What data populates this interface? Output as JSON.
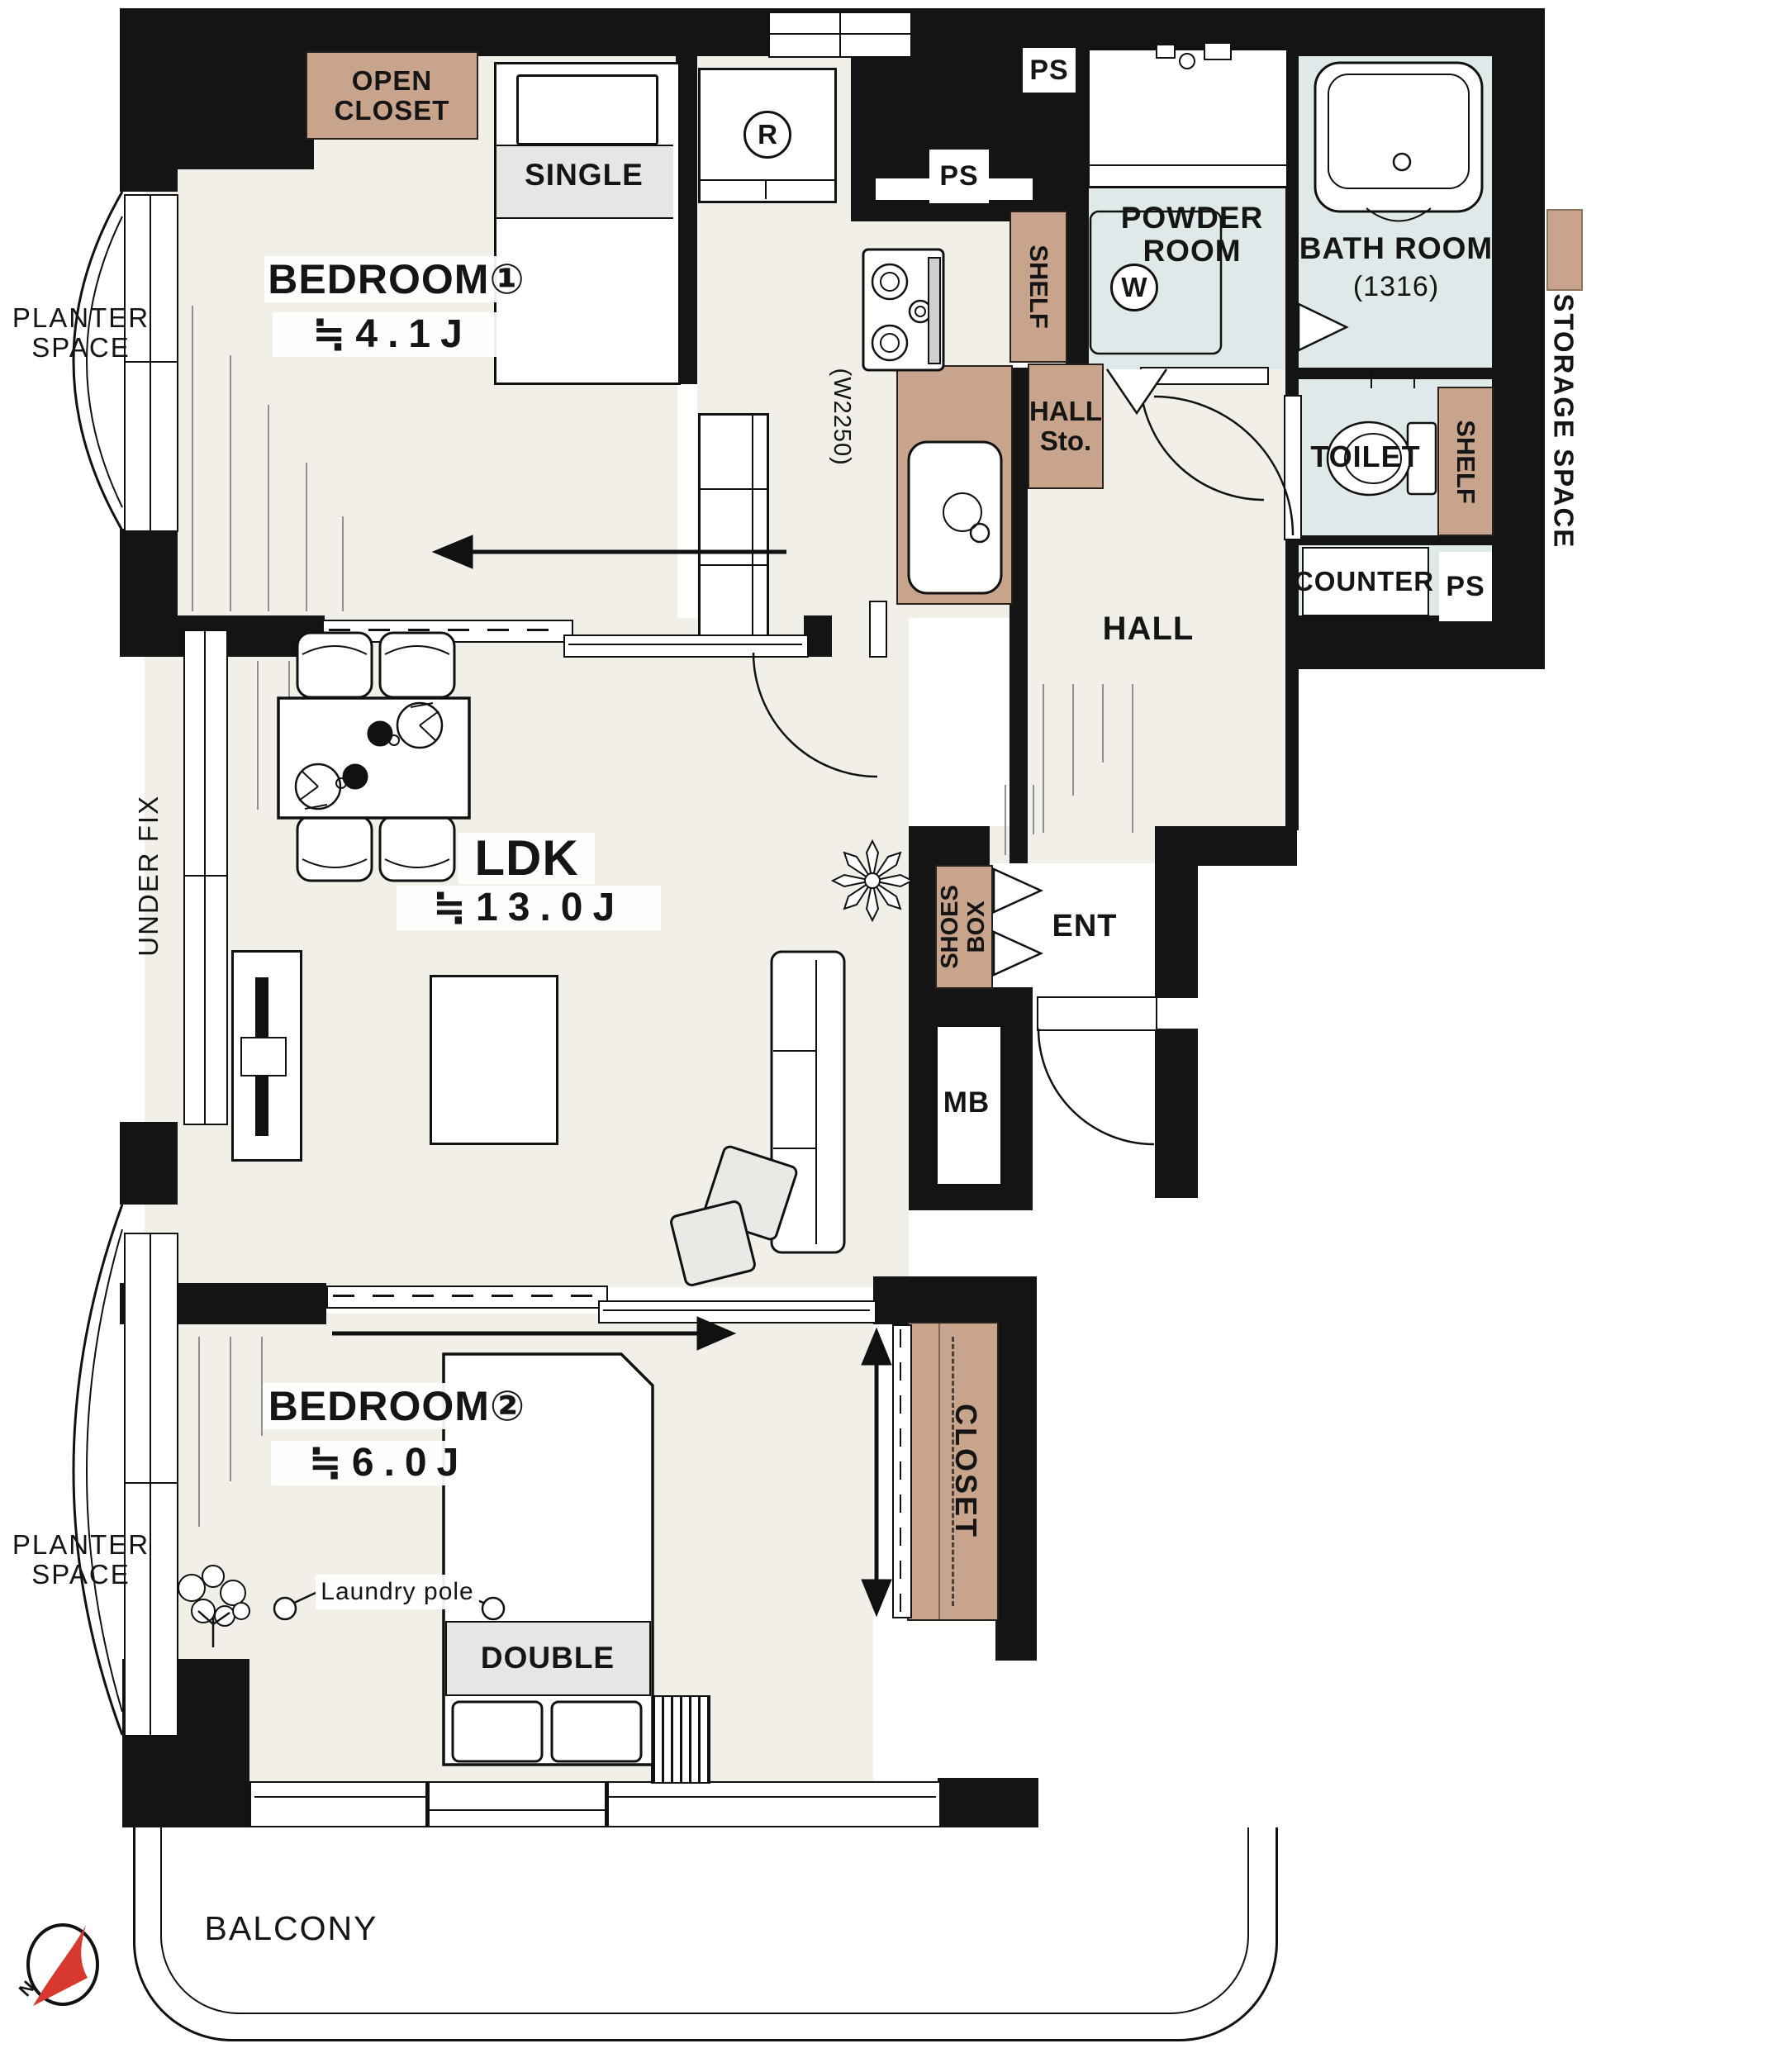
{
  "colors": {
    "wall": "#141414",
    "floor": "#f2efe8",
    "wet": "#dfe9e9",
    "tan": "#c9a48c",
    "grey": "#e6e6e4",
    "accent": "#d8392f",
    "line": "#111111"
  },
  "rooms": {
    "bedroom1": {
      "name": "BEDROOM①",
      "area": "≒4.1J"
    },
    "bedroom2": {
      "name": "BEDROOM②",
      "area": "≒6.0J"
    },
    "ldk": {
      "name": "LDK",
      "area": "≒13.0J"
    },
    "powder": {
      "l1": "POWDER",
      "l2": "ROOM"
    },
    "bath": {
      "name": "BATH ROOM",
      "size": "(1316)"
    },
    "toilet": {
      "name": "TOILET"
    },
    "hall": {
      "name": "HALL"
    },
    "ent": {
      "name": "ENT"
    },
    "balcony": {
      "name": "BALCONY"
    }
  },
  "fixtures": {
    "open_closet": {
      "l1": "OPEN",
      "l2": "CLOSET"
    },
    "single": "SINGLE",
    "double": "DOUBLE",
    "closet": "CLOSET",
    "shelf_kitchen": "SHELF",
    "shelf_toilet": "SHELF",
    "hall_storage": {
      "l1": "HALL",
      "l2": "Sto."
    },
    "shoes_box": {
      "l1": "SHOES",
      "l2": "BOX"
    },
    "counter": "COUNTER",
    "mb": "MB",
    "refrigerator": "R",
    "washer": "W",
    "laundry_pole": "Laundry pole",
    "kitchen_width": "(W2250)",
    "storage_space": "STORAGE SPACE",
    "under_fix": "UNDER FIX",
    "ps": "PS"
  },
  "exterior": {
    "planter": {
      "l1": "PLANTER",
      "l2": "SPACE"
    },
    "compass_n": "N"
  }
}
